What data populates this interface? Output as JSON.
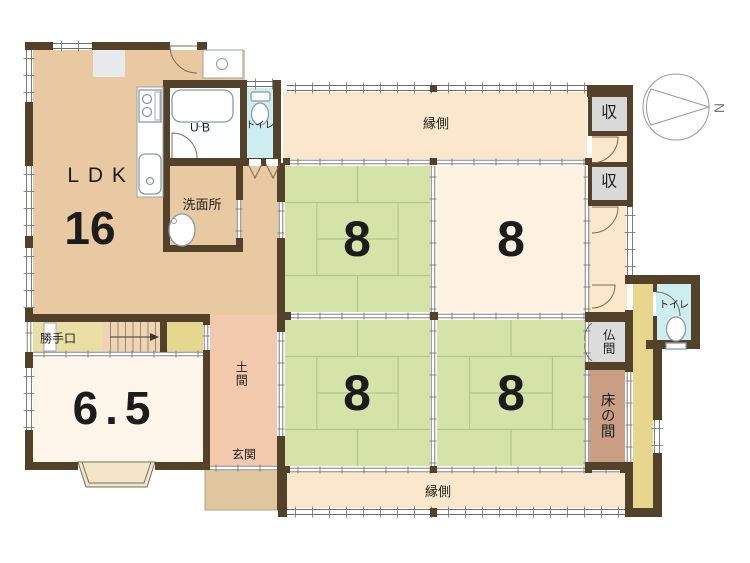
{
  "labels": {
    "ldk_name": "LDK",
    "ldk_size": "16",
    "unit_bath": "U B",
    "toilet_top": "トイレ",
    "washroom": "洗面所",
    "engawa_top": "縁側",
    "closet_top": "収",
    "closet_mid": "収",
    "room8_nw": "8",
    "room8_ne": "8",
    "room8_sw": "8",
    "room8_se": "8",
    "katteguchi": "勝手口",
    "room65_size": "6.5",
    "doma": "土間",
    "genkan": "玄関",
    "butsuma": "仏間",
    "tokonoma": "床の間",
    "toilet_right": "トイレ",
    "engawa_bottom": "縁側",
    "compass_north": "N"
  },
  "colors": {
    "wall": "#54412a",
    "tan": "#e9c9a2",
    "engawa": "#fbe7cc",
    "tatami_green": "#d5e3a9",
    "tatami_line": "#b3c68b",
    "cream_room": "#fdf2e2",
    "white_room": "#fdf5e9",
    "doma_pink": "#f3c9ad",
    "porch": "#e0c69f",
    "corridor_yellow": "#e6d78d",
    "stairs": "#eed3b4",
    "katte_strip": "#e9dfa4",
    "closet_gray": "#d9d9d9",
    "butsuma_gray": "#dcdcdc",
    "tokonoma_brown": "#c99e84",
    "toilet_blue": "#cdeef1",
    "ub_floor": "#fdfeff",
    "fixture_line": "#8d99a4",
    "thin_line": "#6f6f6f"
  }
}
